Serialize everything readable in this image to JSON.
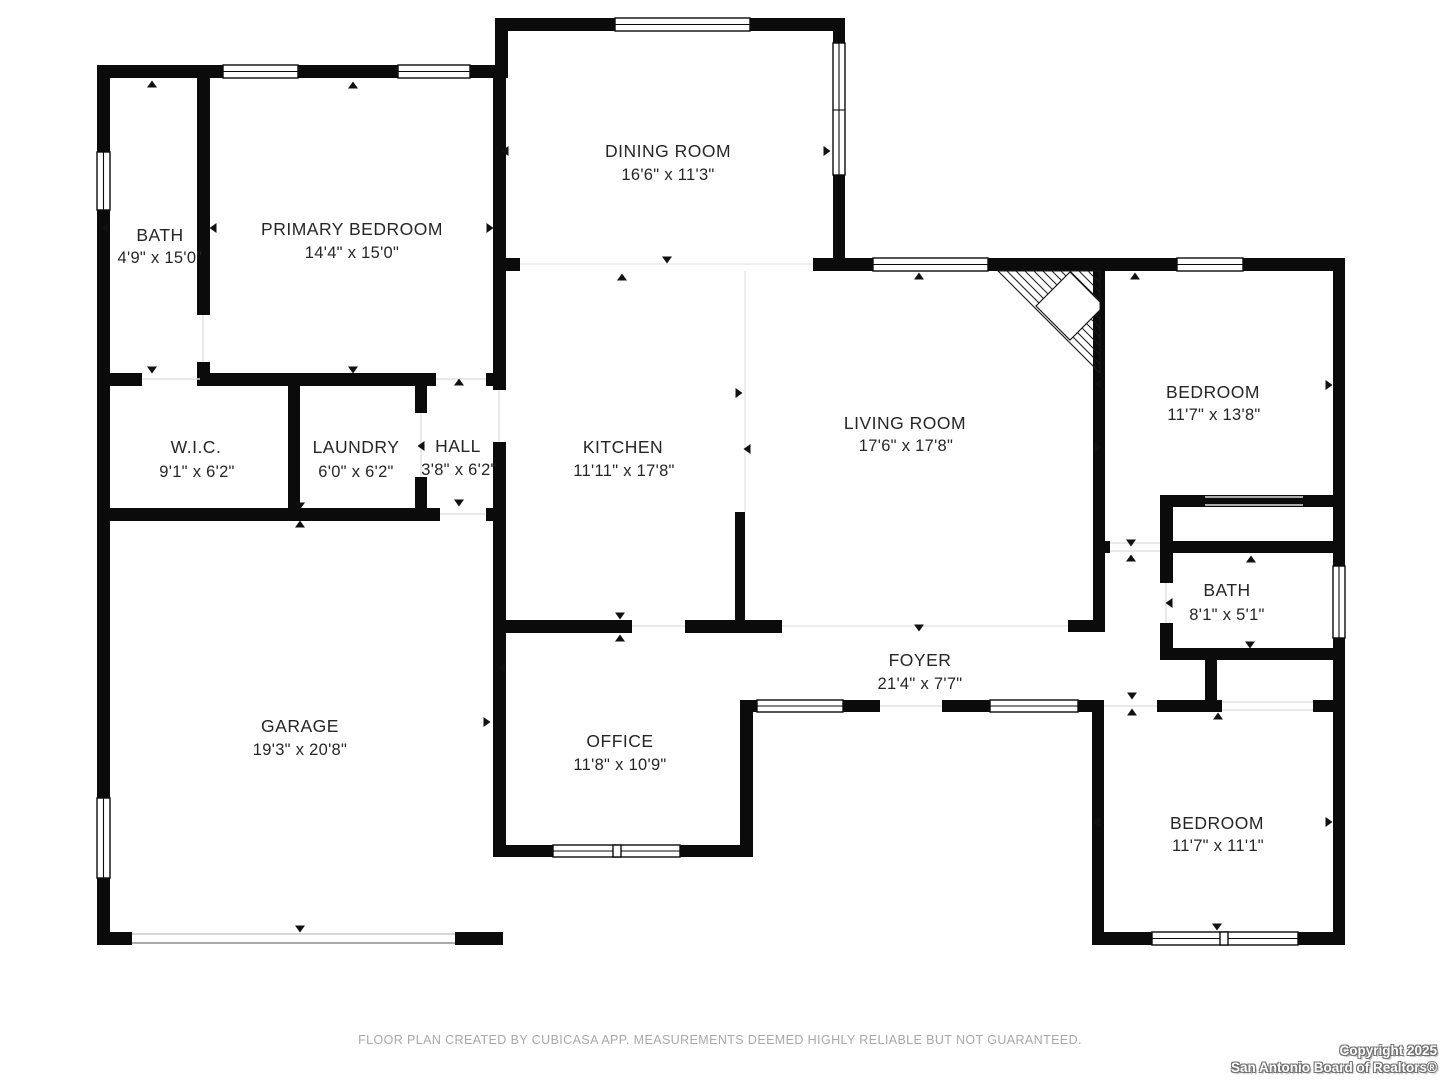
{
  "floor_plan": {
    "rooms": [
      {
        "name": "BATH",
        "dims": "4'9\" x 15'0\""
      },
      {
        "name": "PRIMARY BEDROOM",
        "dims": "14'4\" x 15'0\""
      },
      {
        "name": "DINING ROOM",
        "dims": "16'6\" x 11'3\""
      },
      {
        "name": "W.I.C.",
        "dims": "9'1\" x 6'2\""
      },
      {
        "name": "LAUNDRY",
        "dims": "6'0\" x 6'2\""
      },
      {
        "name": "HALL",
        "dims": "3'8\" x 6'2\""
      },
      {
        "name": "KITCHEN",
        "dims": "11'11\" x 17'8\""
      },
      {
        "name": "LIVING ROOM",
        "dims": "17'6\" x 17'8\""
      },
      {
        "name": "BEDROOM",
        "dims": "11'7\" x 13'8\""
      },
      {
        "name": "BATH",
        "dims": "8'1\" x 5'1\""
      },
      {
        "name": "GARAGE",
        "dims": "19'3\" x 20'8\""
      },
      {
        "name": "OFFICE",
        "dims": "11'8\" x 10'9\""
      },
      {
        "name": "FOYER",
        "dims": "21'4\" x 7'7\""
      },
      {
        "name": "BEDROOM",
        "dims": "11'7\" x 11'1\""
      }
    ],
    "footer": {
      "disclaimer": "FLOOR PLAN CREATED BY CUBICASA APP. MEASUREMENTS DEEMED HIGHLY RELIABLE BUT NOT GUARANTEED."
    },
    "copyright": {
      "line1": "Copyright 2025",
      "line2": "San Antonio Board of Realtors®"
    },
    "colors": {
      "wall": "#0b0b0b",
      "background": "#ffffff",
      "label_text": "#262626",
      "disclaimer_text": "#a8a8a8"
    }
  }
}
